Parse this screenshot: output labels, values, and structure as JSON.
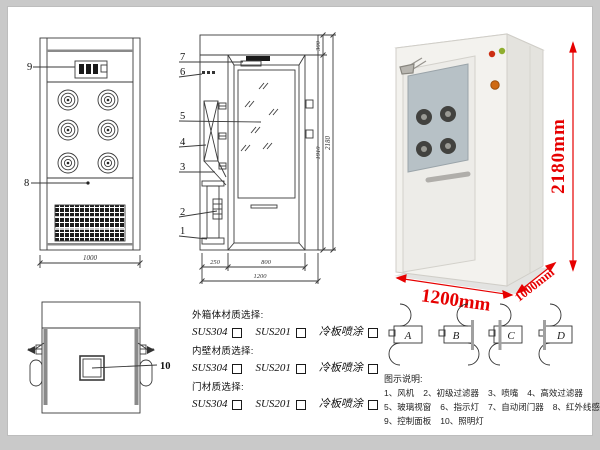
{
  "front_view": {
    "part_labels": {
      "control_panel": "9",
      "infrared_sensor": "8"
    },
    "dims": {
      "width": "1000"
    }
  },
  "side_view": {
    "part_labels": [
      "7",
      "6",
      "5",
      "4",
      "3",
      "2",
      "1"
    ],
    "dims": {
      "top": "300",
      "door_height": "1910",
      "total_height": "2180",
      "left": "250",
      "door_width": "800",
      "total_width": "1200"
    }
  },
  "photo": {
    "dims": {
      "height": "2180mm",
      "width": "1200mm",
      "depth": "1000mm"
    },
    "colors": {
      "dimension": "#e60000",
      "body": "#f3f2ee",
      "glass": "#b7c1c6"
    }
  },
  "top_view": {
    "part_labels": {
      "lighting": "10"
    }
  },
  "materials": {
    "groups": [
      {
        "title": "外箱体材质选择:",
        "options": [
          "SUS304",
          "SUS201",
          "冷板喷涂"
        ]
      },
      {
        "title": "内壁材质选择:",
        "options": [
          "SUS304",
          "SUS201",
          "冷板喷涂"
        ]
      },
      {
        "title": "门材质选择:",
        "options": [
          "SUS304",
          "SUS201",
          "冷板喷涂"
        ]
      }
    ]
  },
  "door_configs": {
    "labels": [
      "A",
      "B",
      "C",
      "D"
    ]
  },
  "legend": {
    "title": "图示说明:",
    "items": [
      "1、风机",
      "2、初级过滤器",
      "3、喷嘴",
      "4、高效过滤器",
      "5、玻璃视窗",
      "6、指示灯",
      "7、自动闭门器",
      "8、红外线感应器",
      "9、控制面板",
      "10、照明灯"
    ]
  }
}
